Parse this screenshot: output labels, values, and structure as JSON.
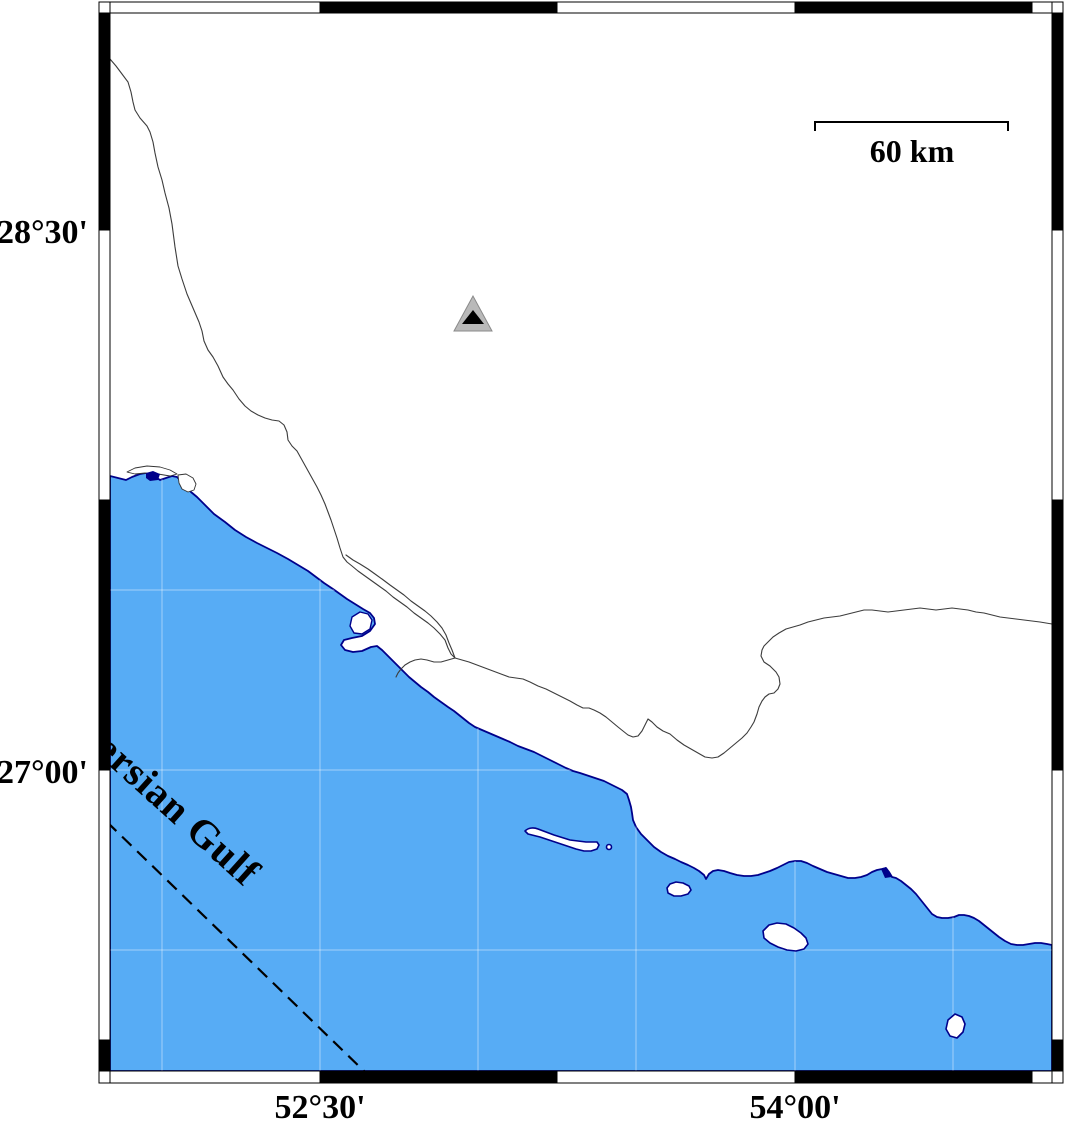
{
  "page": {
    "background": "#ffffff"
  },
  "map": {
    "labels": {
      "lat_top": "28°30'",
      "lat_bottom": "27°00'",
      "lon_left": "52°30'",
      "lon_right": "54°00'",
      "sea_name": "Persian Gulf",
      "scale": "60 km"
    },
    "marker": {
      "shape": "triangle-station"
    },
    "colors": {
      "sea": "#57ACF5",
      "coastline": "#00008B",
      "land_boundary": "#3C3C3C",
      "maritime_dashed": "#000000",
      "frame_black": "#000000",
      "frame_white": "#FFFFFF",
      "marker_fill": "#B9B9B9",
      "marker_core": "#000000",
      "gridline": "#FFFFFF"
    }
  }
}
